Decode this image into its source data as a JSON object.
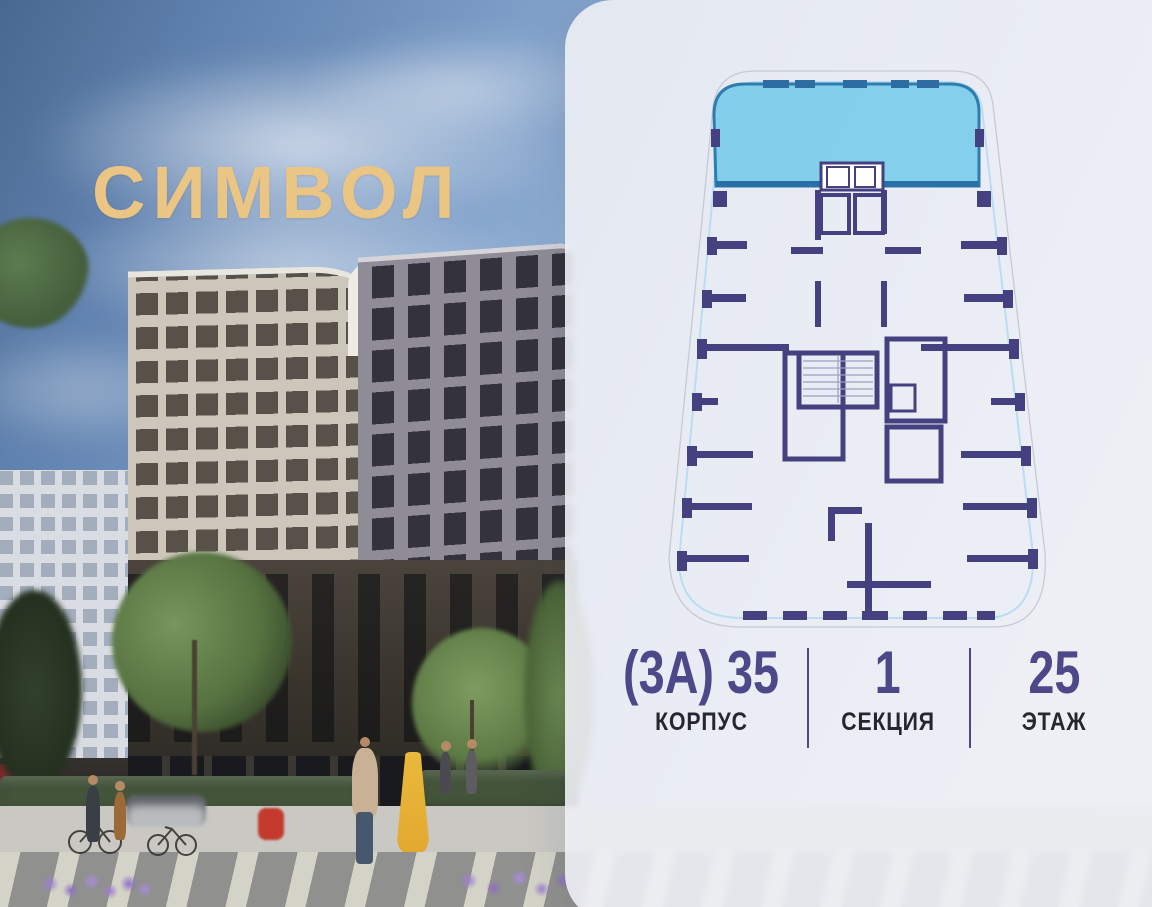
{
  "brand": {
    "name": "СИМВОЛ",
    "color": "#ebc584"
  },
  "panel": {
    "floorplan": {
      "highlighted_apartment": {
        "selected": true,
        "position": "top"
      },
      "wall_color": "#454180",
      "highlight_fill": "#7accea",
      "highlight_stroke": "#2f7cb0"
    },
    "info": {
      "value_color": "#4c4889",
      "items": [
        {
          "value": "(3А) 35",
          "label": "КОРПУС"
        },
        {
          "value": "1",
          "label": "СЕКЦИЯ"
        },
        {
          "value": "25",
          "label": "ЭТАЖ"
        }
      ]
    }
  }
}
